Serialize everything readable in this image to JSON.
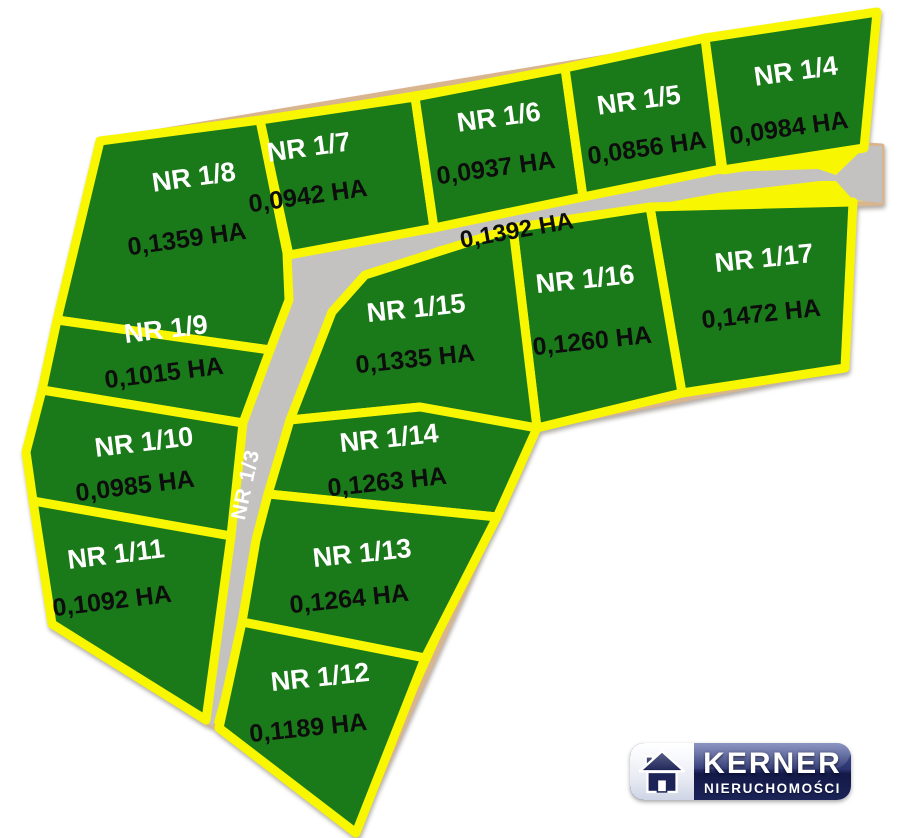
{
  "colors": {
    "plot_green": "#1a7a1a",
    "border_yellow": "#f8f701",
    "road_gray": "#c3c2c1",
    "outline_tan": "#d8b48f",
    "name_white": "#ffffff",
    "area_black": "#0d0d0d",
    "logo_navy": "#1b2357"
  },
  "outline": {
    "points": "100,141 877,12 866,145 882,146 882,203 854,204 845,368 537,428 356,833 219,728 205,722 52,624 26,452"
  },
  "roads": {
    "surface_points": "289,255 434,226 583,197 722,172 818,169 836,175 866,146 882,146 882,203 853,200 836,181 820,181 718,193 585,218 440,246 365,275 332,312 285,435 268,494 256,540 242,622 213,726 205,722 232,530 243,423 255,400 270,350 288,300 287,253",
    "horizontal": {
      "area": "0,1392 HA",
      "x": 518,
      "y": 238,
      "rot": -10
    },
    "vertical": {
      "name": "NR 1/3",
      "x": 252,
      "y": 486,
      "rot": -78
    }
  },
  "plots": [
    {
      "id": "nr-1-8",
      "name": "NR 1/8",
      "area": "0,1359 HA",
      "points": "100,141 260,120 287,253 289,300 270,350 57,320",
      "nx": 195,
      "ny": 186,
      "ax": 188,
      "ay": 247,
      "rot": -8
    },
    {
      "id": "nr-1-7",
      "name": "NR 1/7",
      "area": "0,0942 HA",
      "points": "260,120 415,97 434,228 289,255",
      "nx": 310,
      "ny": 156,
      "ax": 309,
      "ay": 204,
      "rot": -8
    },
    {
      "id": "nr-1-6",
      "name": "NR 1/6",
      "area": "0,0937 HA",
      "points": "415,97 565,68 583,197 434,228",
      "nx": 500,
      "ny": 126,
      "ax": 497,
      "ay": 176,
      "rot": -8
    },
    {
      "id": "nr-1-5",
      "name": "NR 1/5",
      "area": "0,0856 HA",
      "points": "565,68 705,38 721,169 583,197",
      "nx": 640,
      "ny": 109,
      "ax": 648,
      "ay": 156,
      "rot": -8
    },
    {
      "id": "nr-1-4",
      "name": "NR 1/4",
      "area": "0,0984 HA",
      "points": "705,38 877,12 864,148 723,170",
      "nx": 797,
      "ny": 80,
      "ax": 790,
      "ay": 136,
      "rot": -8
    },
    {
      "id": "nr-1-17",
      "name": "NR 1/17",
      "area": "0,1472 HA",
      "points": "650,207 853,202 845,368 682,393",
      "nx": 765,
      "ny": 267,
      "ax": 762,
      "ay": 322,
      "rot": -6
    },
    {
      "id": "nr-1-16",
      "name": "NR 1/16",
      "area": "0,1260 HA",
      "points": "513,228 650,207 682,393 537,428",
      "nx": 586,
      "ny": 288,
      "ax": 593,
      "ay": 349,
      "rot": -6
    },
    {
      "id": "nr-1-15",
      "name": "NR 1/15",
      "area": "0,1335 HA",
      "points": "365,275 513,228 537,428 420,407 290,420 332,312",
      "nx": 417,
      "ny": 317,
      "ax": 416,
      "ay": 367,
      "rot": -6
    },
    {
      "id": "nr-1-9",
      "name": "NR 1/9",
      "area": "0,1015 HA",
      "points": "57,320 270,350 243,423 42,390",
      "nx": 167,
      "ny": 338,
      "ax": 165,
      "ay": 381,
      "rot": -7
    },
    {
      "id": "nr-1-10",
      "name": "NR 1/10",
      "area": "0,0985 HA",
      "points": "42,390 243,423 231,536 33,501 26,452",
      "nx": 145,
      "ny": 451,
      "ax": 136,
      "ay": 494,
      "rot": -7
    },
    {
      "id": "nr-1-11",
      "name": "NR 1/11",
      "area": "0,1092 HA",
      "points": "33,501 231,536 206,720 52,624",
      "nx": 117,
      "ny": 563,
      "ax": 113,
      "ay": 609,
      "rot": -7
    },
    {
      "id": "nr-1-14",
      "name": "NR 1/14",
      "area": "0,1263 HA",
      "points": "290,420 420,407 537,428 497,517 268,494 285,437",
      "nx": 390,
      "ny": 447,
      "ax": 388,
      "ay": 490,
      "rot": -6
    },
    {
      "id": "nr-1-13",
      "name": "NR 1/13",
      "area": "0,1264 HA",
      "points": "268,494 497,517 425,658 242,622 256,540",
      "nx": 363,
      "ny": 562,
      "ax": 350,
      "ay": 607,
      "rot": -6
    },
    {
      "id": "nr-1-12",
      "name": "NR 1/12",
      "area": "0,1189 HA",
      "points": "242,622 425,658 356,833 219,728",
      "nx": 321,
      "ny": 686,
      "ax": 309,
      "ay": 736,
      "rot": -6
    }
  ],
  "logo": {
    "brand": "KERNER",
    "subtitle": "NIERUCHOMOŚCI"
  }
}
